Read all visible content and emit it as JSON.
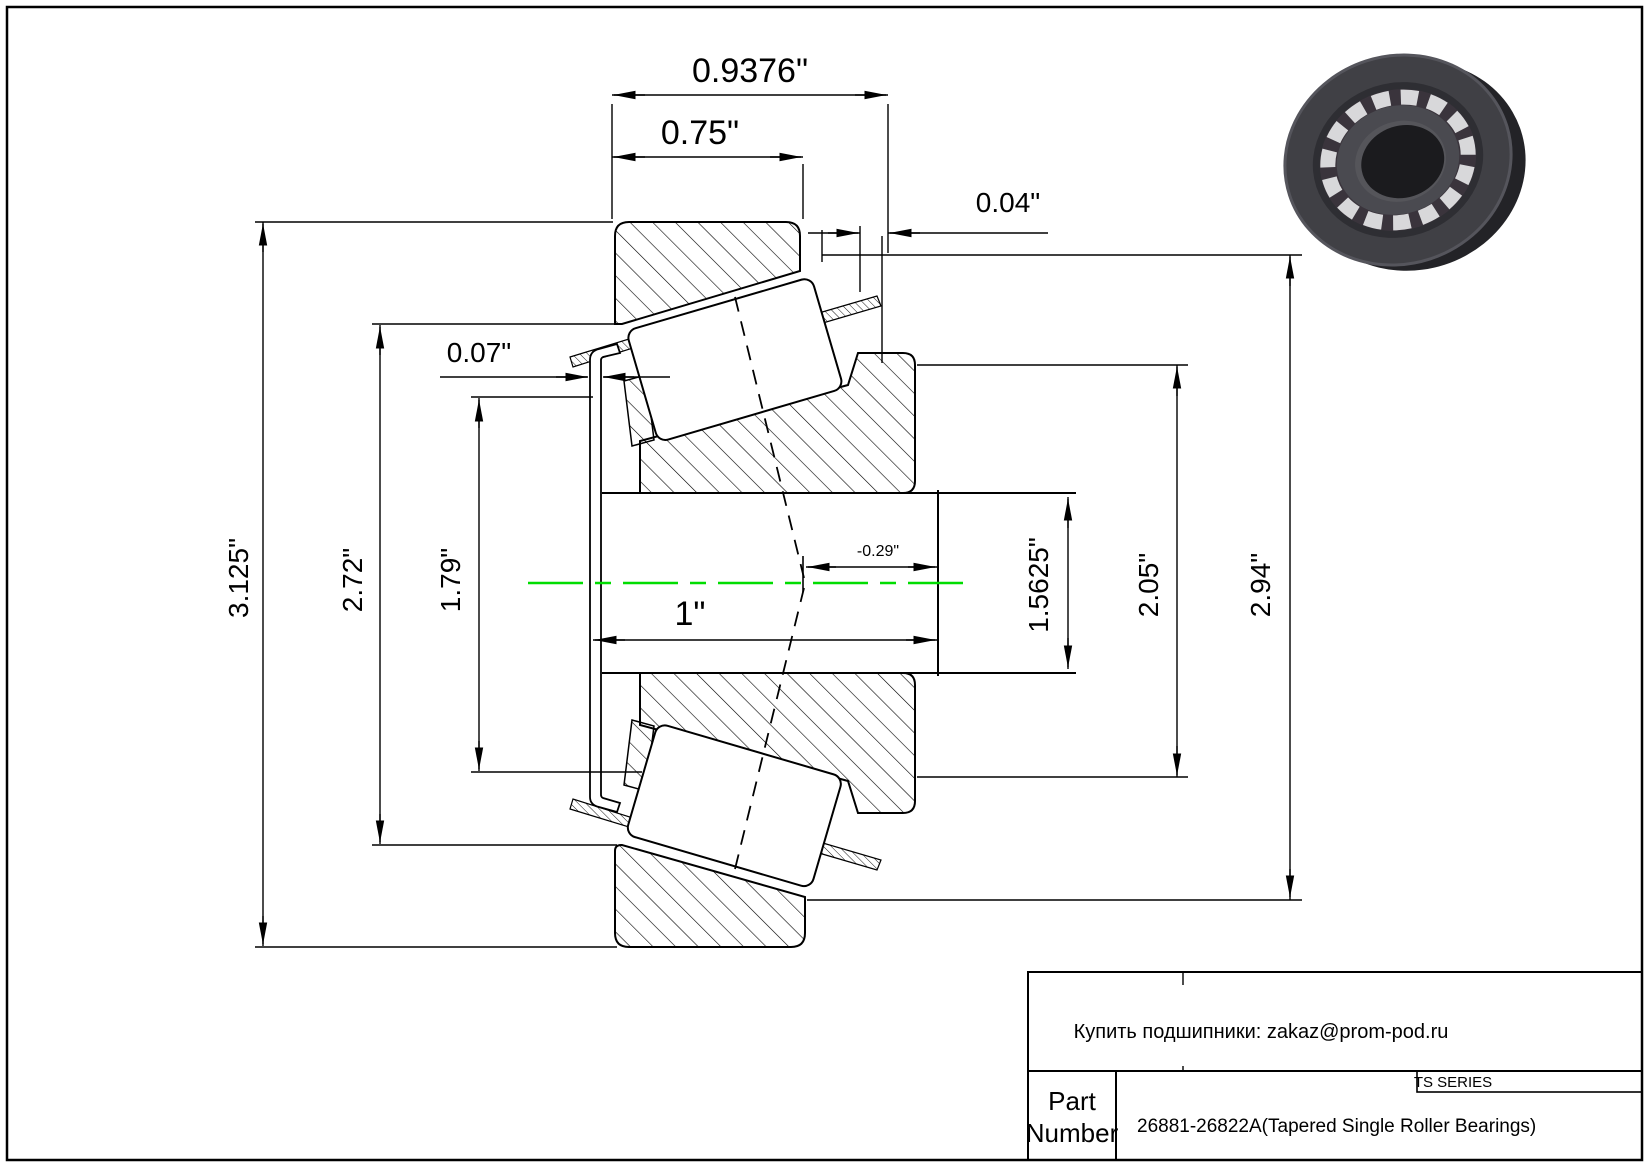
{
  "drawing_labels": {
    "dim_outer_total_width": "0.9376\"",
    "dim_cup_width": "0.75\"",
    "dim_standout": "0.04\"",
    "dim_flange_thickness": "0.07\"",
    "dim_flange_od": "3.125\"",
    "dim_outer_diameter": "2.72\"",
    "dim_cup_inner": "1.79\"",
    "dim_cone_width": "1\"",
    "dim_effective_center": "-0.29\"",
    "dim_bore": "1.5625\"",
    "dim_cone_back_od": "2.05\"",
    "dim_housing": "2.94\""
  },
  "title_block": {
    "contact": "Купить подшипники: zakaz@prom-pod.ru",
    "series": "TS SERIES",
    "part_label_line1": "Part",
    "part_label_line2": "Number",
    "part_number": "26881-26822A(Tapered Single Roller Bearings)"
  },
  "colors": {
    "centerline_green": "#00DD00",
    "line_black": "#000000"
  }
}
